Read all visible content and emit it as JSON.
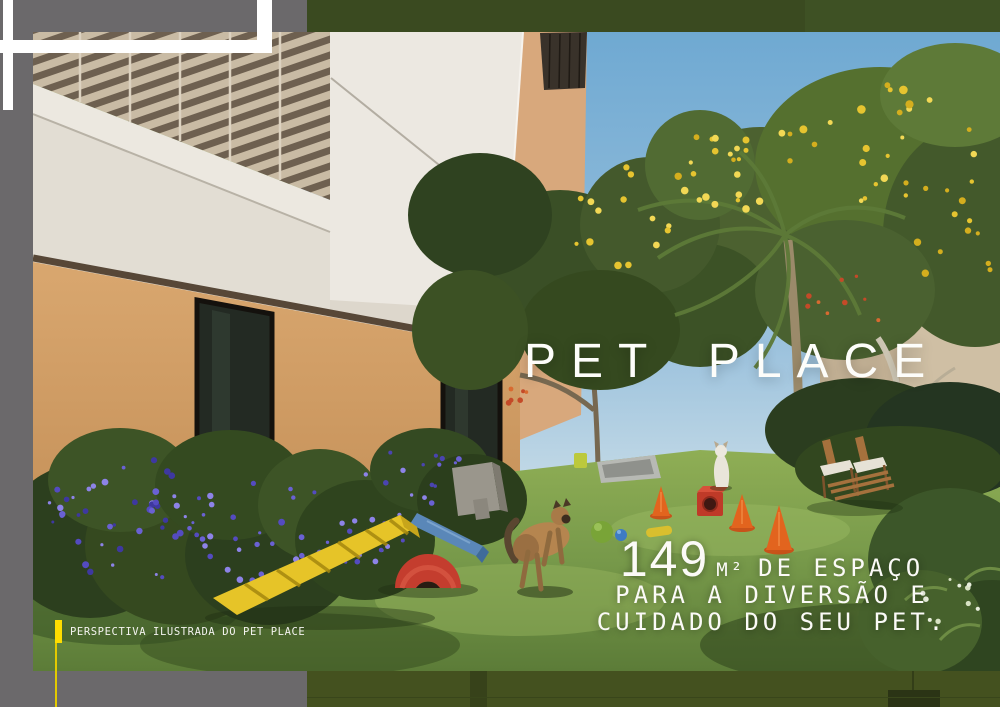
{
  "photo": {
    "title": "PET PLACE",
    "caption": "PERSPECTIVA ILUSTRADA DO PET PLACE"
  },
  "stats": {
    "value": "149",
    "unit": "M²",
    "line1": "DE ESPAÇO",
    "line2": "PARA A DIVERSÃO E",
    "line3": "CUIDADO DO SEU PET."
  },
  "colors": {
    "accent_yellow": "#ffdd00",
    "brand_green_dark": "#3a4a20",
    "brand_green": "#44511f",
    "panel_gray": "#6b696b",
    "text_white": "#ffffff",
    "terracotta_wall": "#d09a64",
    "ramp_yellow": "#e6c428",
    "tunnel_red": "#c43d2e",
    "ramp_blue": "#5a87b8",
    "cone_orange": "#e2641e"
  }
}
